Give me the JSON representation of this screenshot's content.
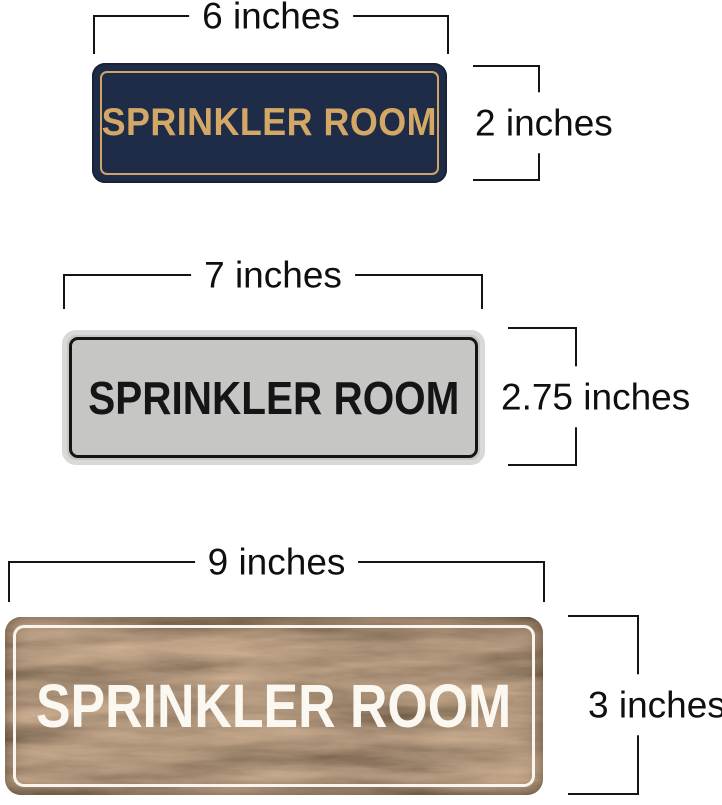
{
  "image_type": "product-size-comparison-diagram",
  "background_color": "#ffffff",
  "annotation": {
    "line_color": "#141414",
    "text_color": "#0f0f0f"
  },
  "signs": [
    {
      "id": "navy-gold",
      "label": "SPRINKLER ROOM",
      "width_label": "6 inches",
      "height_label": "2 inches",
      "colors": {
        "face": "#1f2c47",
        "inner_border": "#cda567",
        "text": "#d3a867"
      }
    },
    {
      "id": "silver-black",
      "label": "SPRINKLER ROOM",
      "width_label": "7 inches",
      "height_label": "2.75 inches",
      "colors": {
        "face": "#c6c6c4",
        "rim": "#d9d9d7",
        "inner_border": "#141414",
        "text": "#151515"
      }
    },
    {
      "id": "walnut-white",
      "label": "SPRINKLER ROOM",
      "width_label": "9 inches",
      "height_label": "3 inches",
      "colors": {
        "face": "#6a4a30",
        "inner_border": "#f7f5ee",
        "text": "#faf8f1"
      }
    }
  ]
}
